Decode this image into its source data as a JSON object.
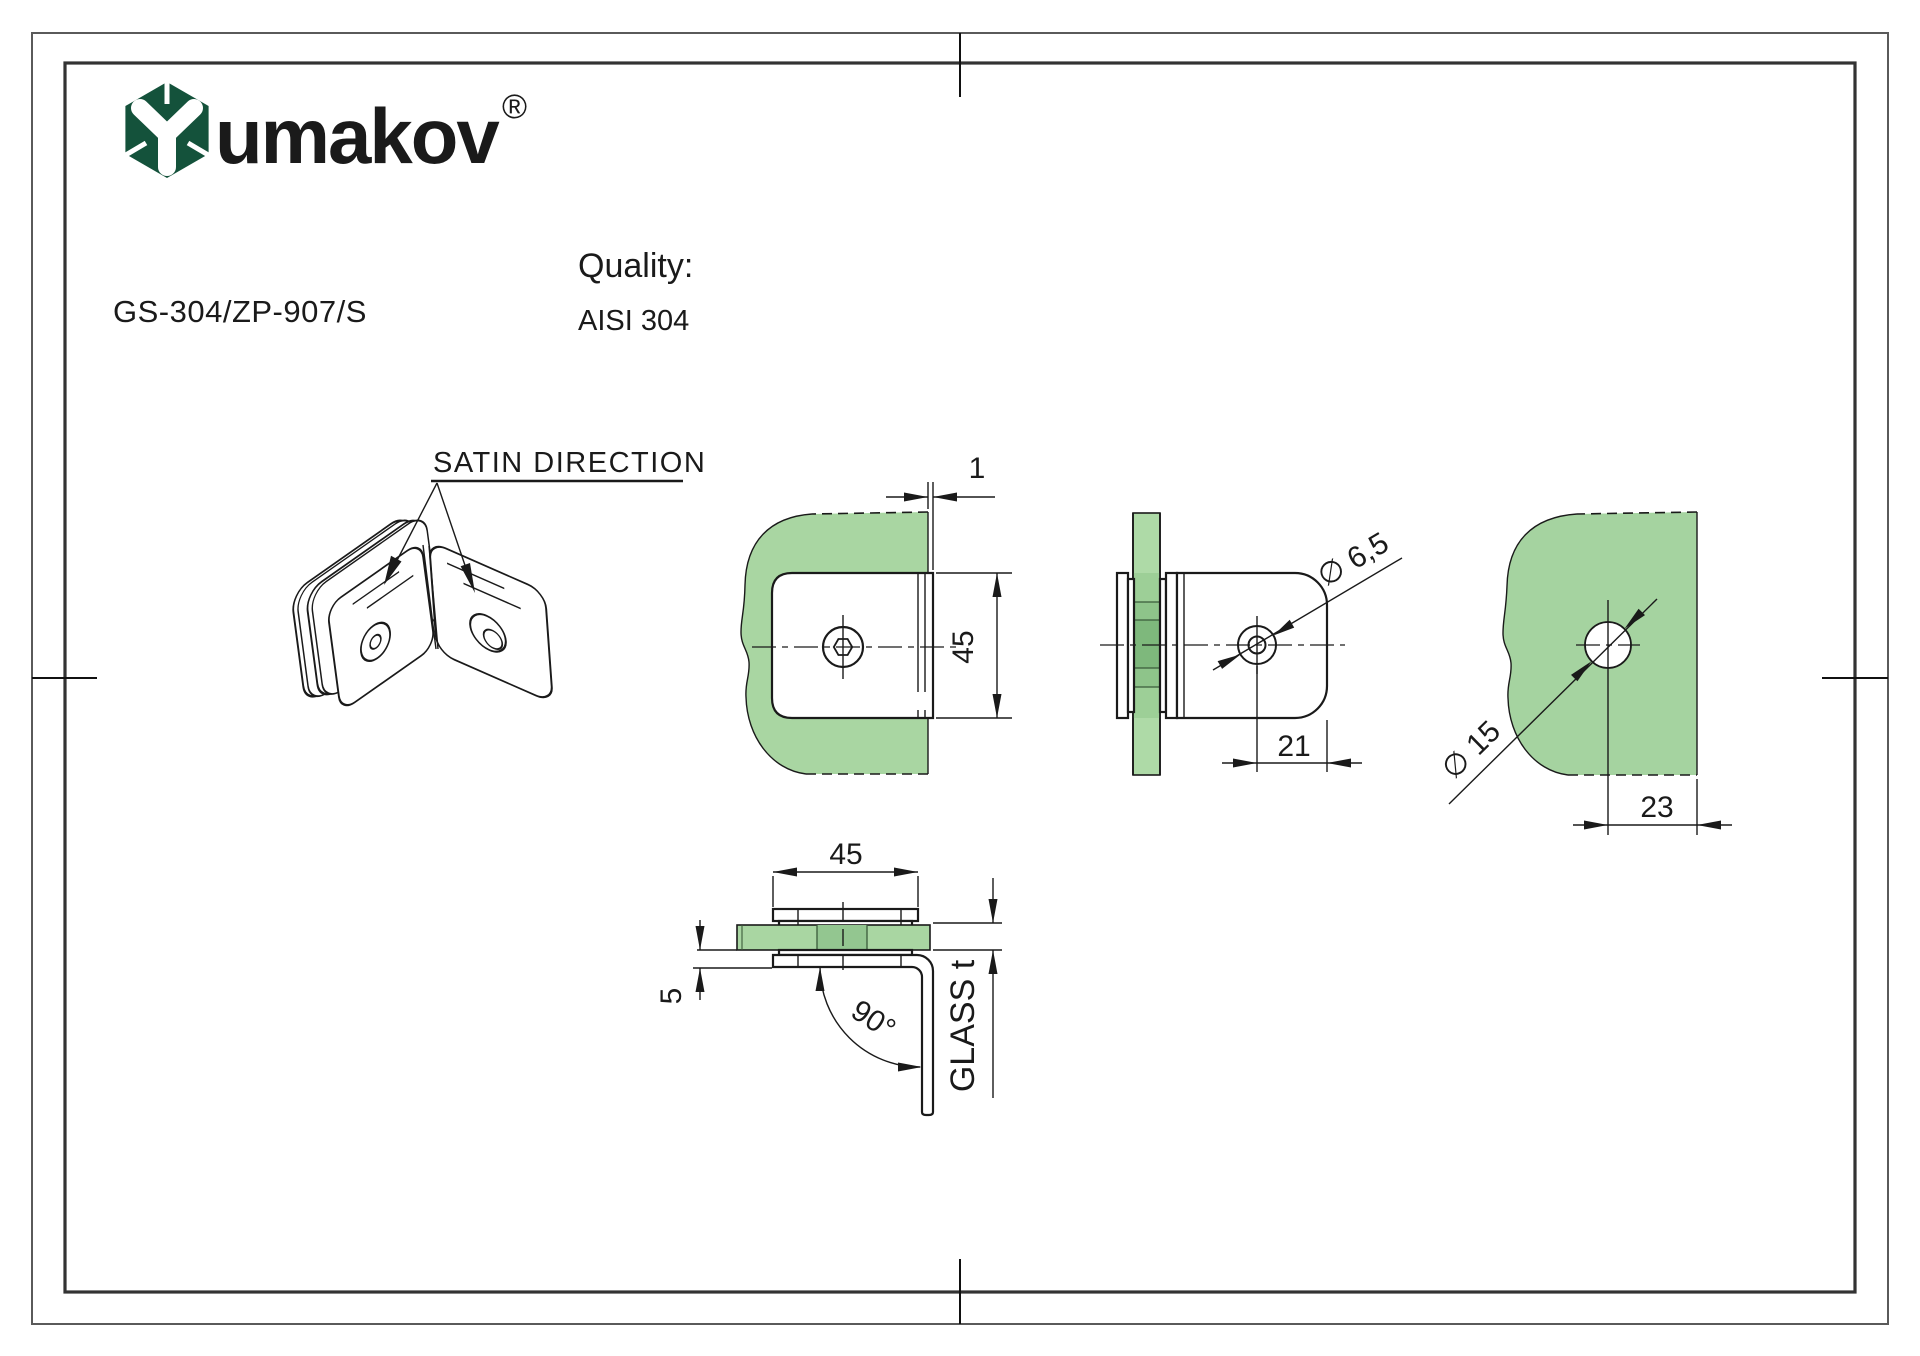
{
  "logo": {
    "brand": "umakov",
    "registered": "®"
  },
  "header": {
    "product_code": "GS-304/ZP-907/S",
    "quality_label": "Quality:",
    "quality_value": "AISI 304"
  },
  "drawing": {
    "satin_direction": "SATIN DIRECTION",
    "dim_gap": "1",
    "dim_plate_height": "45",
    "dim_hole_dia": "∅ 6,5",
    "dim_hole_offset": "21",
    "dim_glass_hole_dia": "∅ 15",
    "dim_glass_hole_offset": "23",
    "dim_plate_width": "45",
    "dim_clamp_thickness": "5",
    "dim_bend_angle": "90°",
    "dim_glass_thickness": "GLASS t"
  },
  "colors": {
    "logo_green": "#14523b",
    "glass_green": "#a9d6a2",
    "glass_green_mid": "#93c690",
    "glass_green_dark": "#7eb87c",
    "line": "#1a1a1a"
  }
}
